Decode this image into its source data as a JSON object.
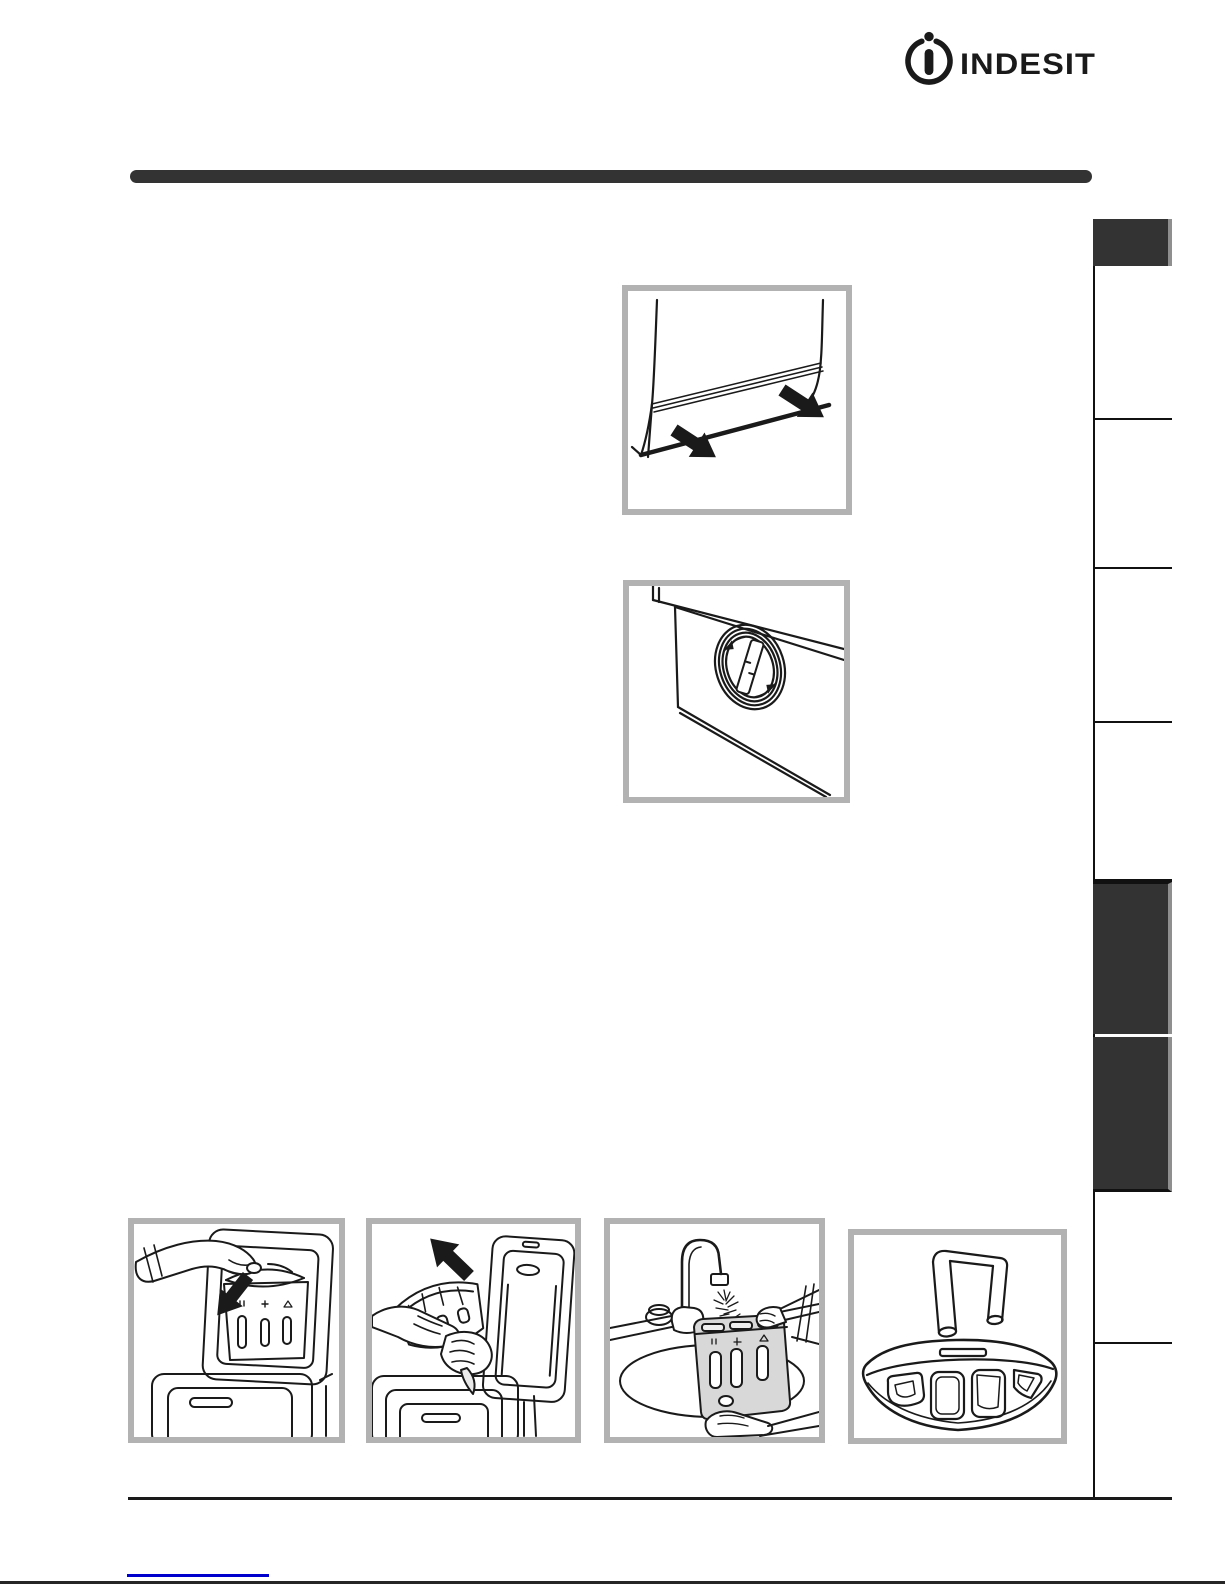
{
  "page": {
    "width": 1225,
    "height": 1585,
    "background": "#ffffff"
  },
  "brand": {
    "logo_text": "INDESIT",
    "logo_icon": "indesit-circle-i-icon"
  },
  "colors": {
    "dark": "#333333",
    "frame_border": "#b2b2b2",
    "rule_black": "#1a1a1a",
    "link_blue": "#0000cc",
    "drawing_stroke": "#1a1a1a",
    "drawer_fill": "#d8d8d8"
  },
  "sidebar": {
    "language_tab_label": "",
    "highlighted_tab_1_label": "",
    "highlighted_tab_2_label": ""
  },
  "figures": {
    "fig1": "kick-strip-removal-figure",
    "fig2": "pump-cover-figure",
    "fig3": "drawer-button-press-figure",
    "fig4": "drawer-removal-figure",
    "fig5": "drawer-rinsing-figure",
    "fig6": "siphon-parts-figure"
  },
  "footer": {
    "link_label": ""
  }
}
